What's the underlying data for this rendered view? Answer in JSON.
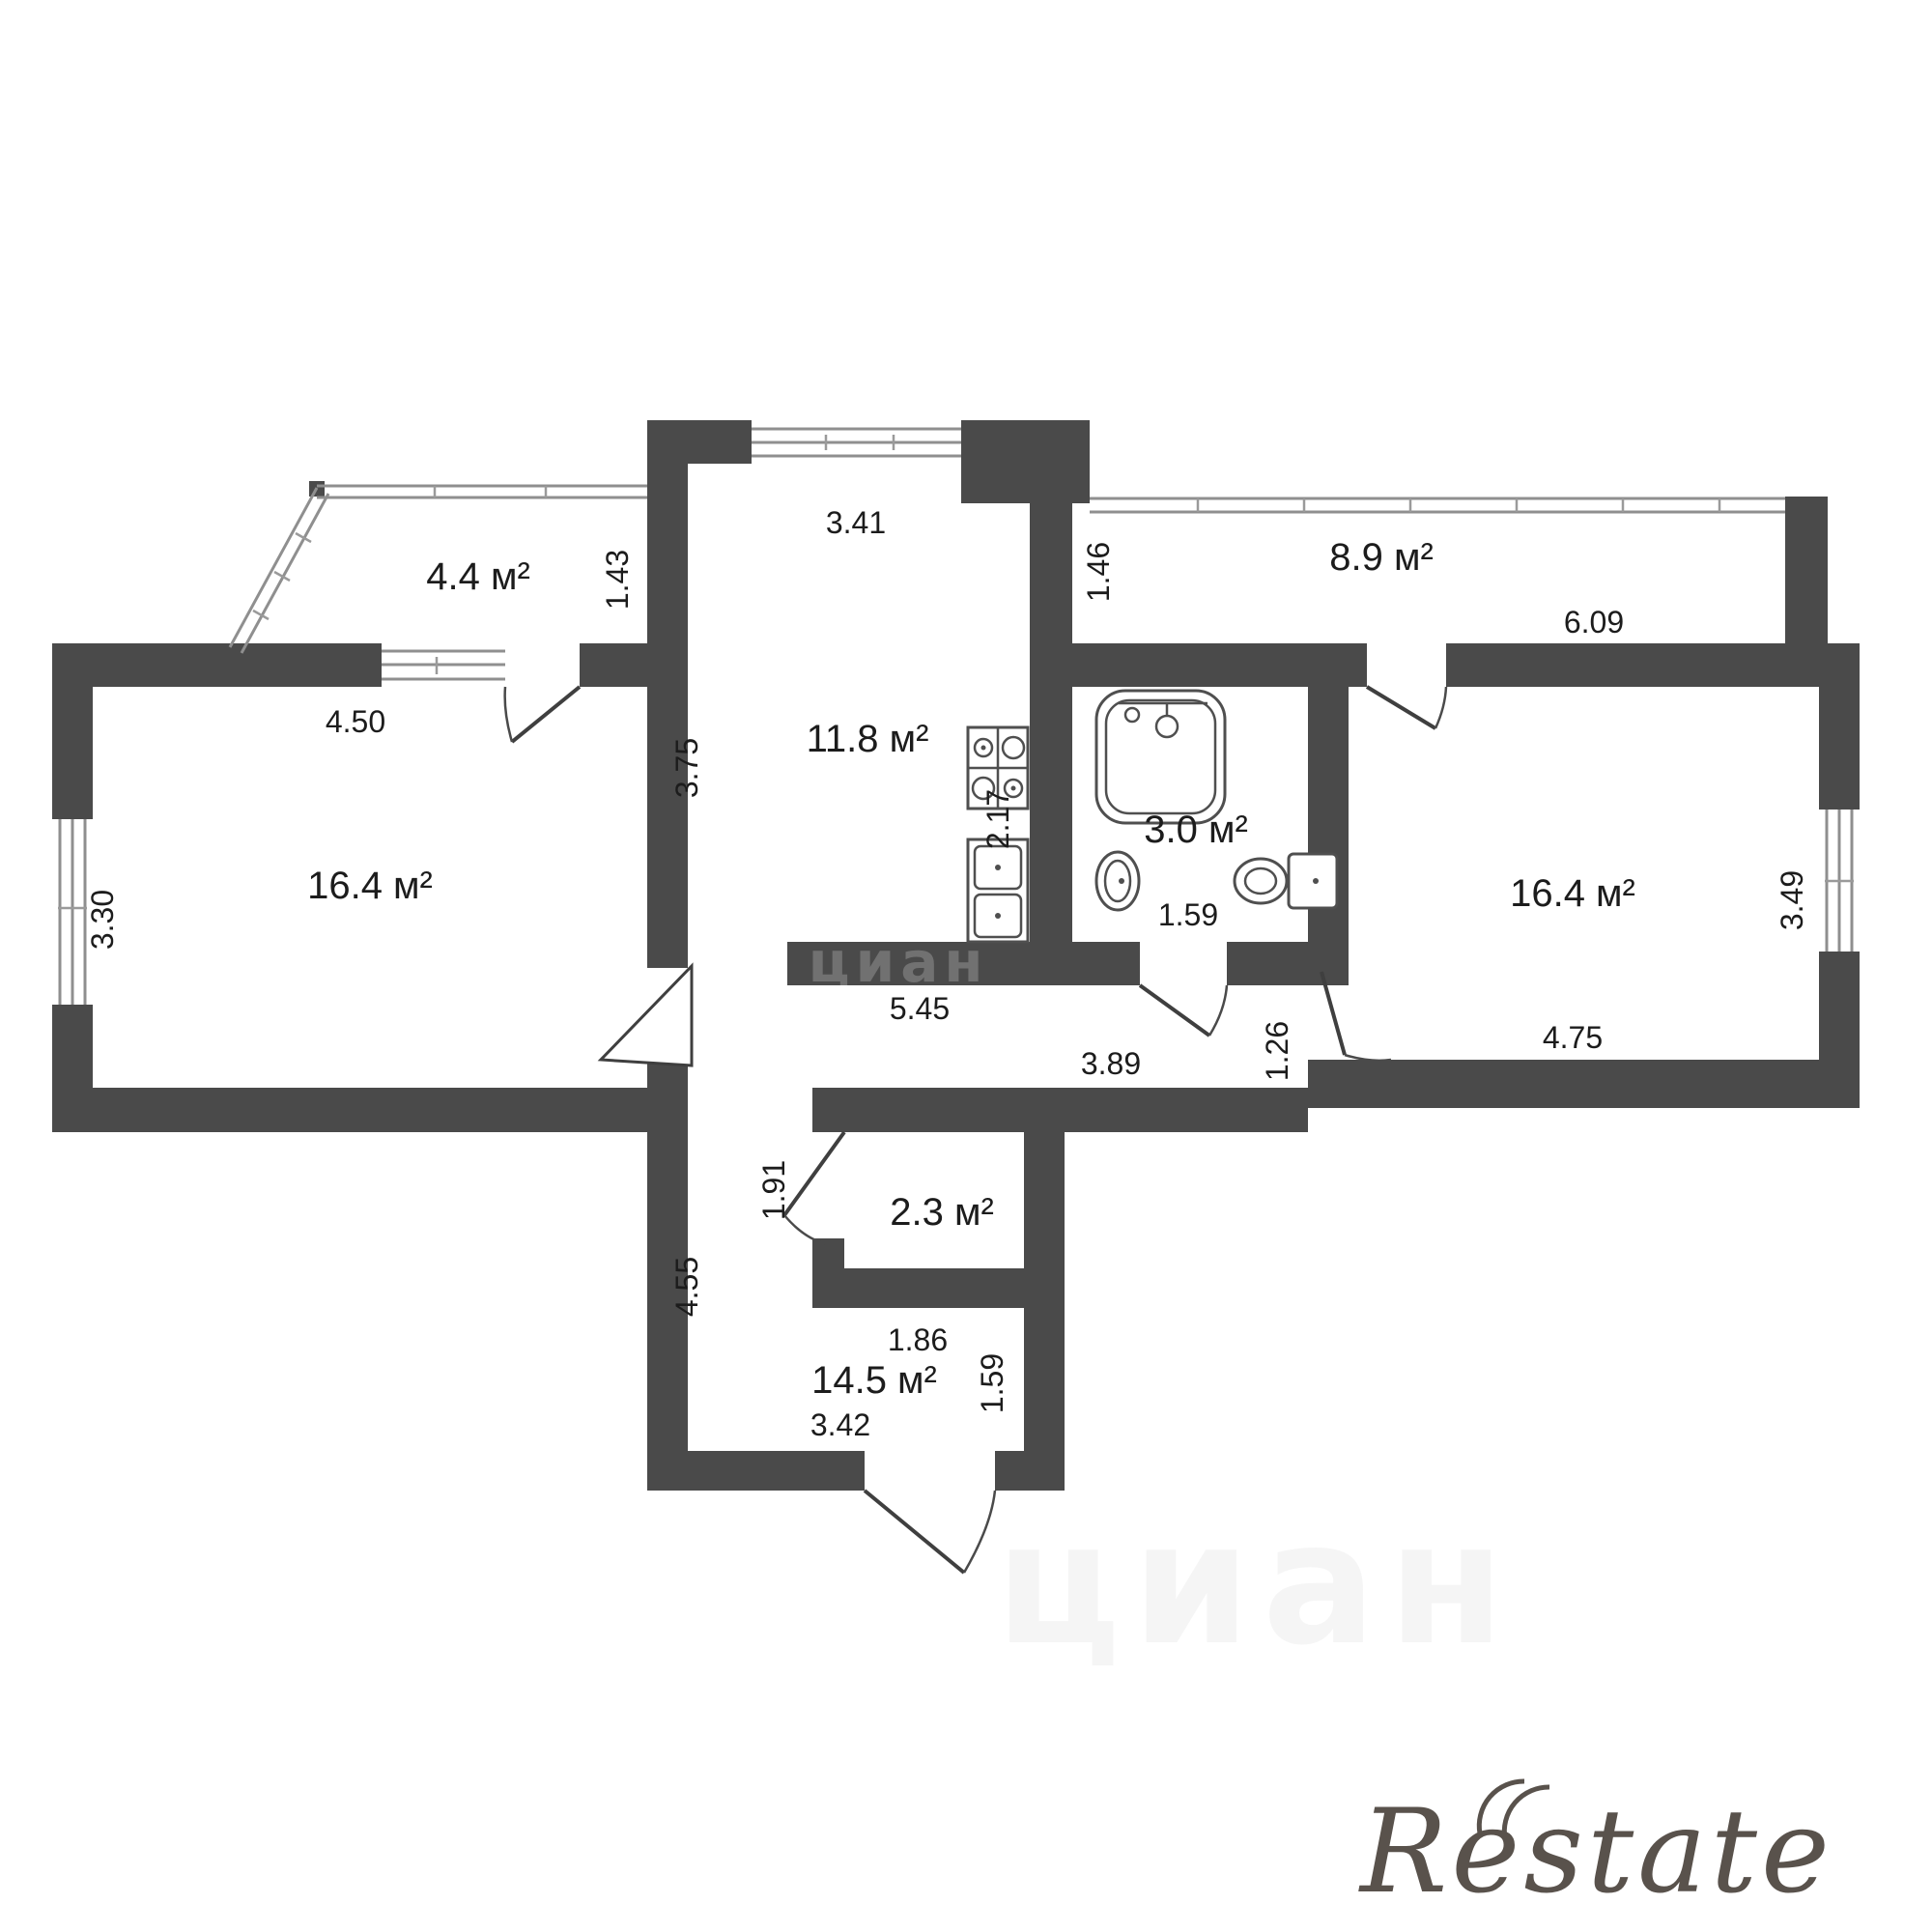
{
  "plan": {
    "type": "apartment-floor-plan",
    "wall_color": "#4a4a4a",
    "background": "#ffffff",
    "rooms": [
      {
        "name": "balcony-left",
        "area": "4.4 м²",
        "dims": [
          "4.50",
          "1.43"
        ]
      },
      {
        "name": "kitchen",
        "area": "11.8 м²",
        "dims": [
          "3.41",
          "3.75",
          "2.17",
          "5.45"
        ]
      },
      {
        "name": "balcony-right",
        "area": "8.9 м²",
        "dims": [
          "1.46",
          "6.09"
        ]
      },
      {
        "name": "room-left",
        "area": "16.4 м²",
        "dims": [
          "3.30",
          "4.50"
        ]
      },
      {
        "name": "bathroom",
        "area": "3.0 м²",
        "dims": [
          "1.59"
        ]
      },
      {
        "name": "room-right",
        "area": "16.4 м²",
        "dims": [
          "3.49",
          "4.75",
          "1.26"
        ]
      },
      {
        "name": "hallway",
        "area": null,
        "dims": [
          "3.89",
          "4.55",
          "5.45"
        ]
      },
      {
        "name": "closet",
        "area": "2.3 м²",
        "dims": [
          "1.91",
          "1.86"
        ]
      },
      {
        "name": "room-bottom",
        "area": "14.5 м²",
        "dims": [
          "3.42",
          "1.59",
          "1.86"
        ]
      }
    ],
    "icons": [
      "stove-icon",
      "kitchen-sink-icon",
      "bathtub-icon",
      "washbasin-icon",
      "toilet-icon"
    ]
  },
  "labels": {
    "balcony_left_area": "4.4 м²",
    "balcony_left_depth": "1.43",
    "room_left_top": "4.50",
    "room_left_area": "16.4 м²",
    "room_left_window": "3.30",
    "kitchen_area": "11.8 м²",
    "kitchen_width": "3.41",
    "kitchen_height": "3.75",
    "kitchen_sink_dim": "2.17",
    "kitchen_hall_span": "5.45",
    "balcony_right_area": "8.9 м²",
    "balcony_right_depth": "1.46",
    "balcony_right_width": "6.09",
    "bathroom_area": "3.0 м²",
    "bathroom_width": "1.59",
    "room_right_area": "16.4 м²",
    "room_right_window": "3.49",
    "room_right_width": "4.75",
    "room_right_door": "1.26",
    "hall_width": "3.89",
    "hall_height": "4.55",
    "closet_area": "2.3 м²",
    "closet_door": "1.91",
    "closet_width": "1.86",
    "room_bottom_area": "14.5 м²",
    "room_bottom_side": "1.59",
    "room_bottom_width": "3.42",
    "watermark_cian": "циан",
    "watermark_cian_wall": "циан",
    "watermark_restate": "Restate"
  }
}
